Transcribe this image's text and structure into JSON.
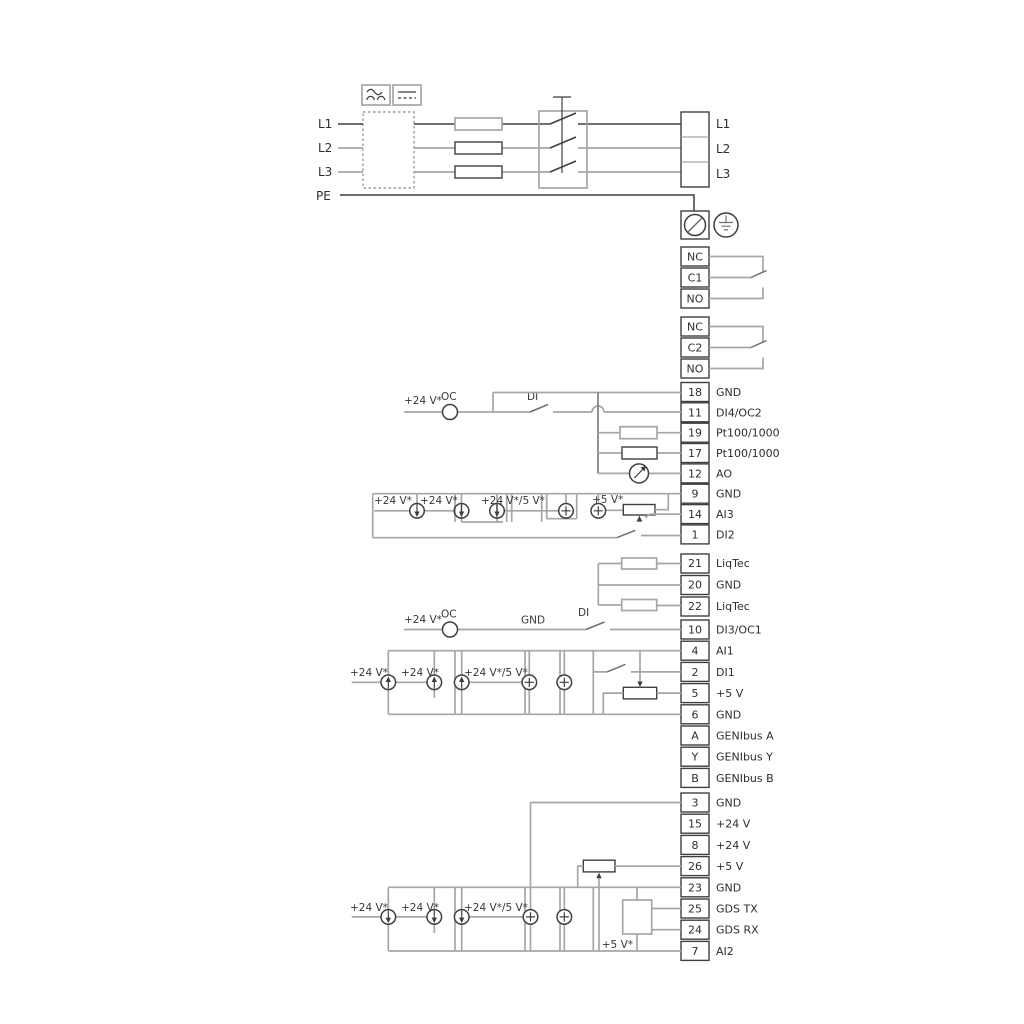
{
  "diagram_title": "pump-drive-wiring-diagram",
  "colors": {
    "wire_dark": "#3f3f3f",
    "wire_gray": "#a6a6a6",
    "text": "#2e2e2e",
    "background": "#ffffff"
  },
  "power": {
    "inputs": [
      {
        "label": "L1"
      },
      {
        "label": "L2"
      },
      {
        "label": "L3"
      }
    ],
    "pe_label": "PE",
    "outputs": [
      {
        "label": "L1"
      },
      {
        "label": "L2"
      },
      {
        "label": "L3"
      }
    ]
  },
  "relays": {
    "r1": {
      "rows": [
        {
          "n": "NC"
        },
        {
          "n": "C1"
        },
        {
          "n": "NO"
        }
      ]
    },
    "r2": {
      "rows": [
        {
          "n": "NC"
        },
        {
          "n": "C2"
        },
        {
          "n": "NO"
        }
      ]
    }
  },
  "strip1": {
    "rows": [
      {
        "n": "18",
        "l": "GND"
      },
      {
        "n": "11",
        "l": "DI4/OC2"
      },
      {
        "n": "19",
        "l": "Pt100/1000"
      },
      {
        "n": "17",
        "l": "Pt100/1000"
      },
      {
        "n": "12",
        "l": "AO"
      },
      {
        "n": "9",
        "l": "GND"
      },
      {
        "n": "14",
        "l": "AI3"
      },
      {
        "n": "1",
        "l": "DI2"
      }
    ]
  },
  "strip2": {
    "rows": [
      {
        "n": "21",
        "l": "LiqTec"
      },
      {
        "n": "20",
        "l": "GND"
      },
      {
        "n": "22",
        "l": "LiqTec"
      }
    ]
  },
  "strip3": {
    "rows": [
      {
        "n": "10",
        "l": "DI3/OC1"
      },
      {
        "n": "4",
        "l": "AI1"
      },
      {
        "n": "2",
        "l": "DI1"
      },
      {
        "n": "5",
        "l": "+5 V"
      },
      {
        "n": "6",
        "l": "GND"
      },
      {
        "n": "A",
        "l": "GENIbus A"
      },
      {
        "n": "Y",
        "l": "GENIbus Y"
      },
      {
        "n": "B",
        "l": "GENIbus B"
      }
    ]
  },
  "strip4": {
    "rows": [
      {
        "n": "3",
        "l": "GND"
      },
      {
        "n": "15",
        "l": "+24 V"
      },
      {
        "n": "8",
        "l": "+24 V"
      },
      {
        "n": "26",
        "l": "+5 V"
      },
      {
        "n": "23",
        "l": "GND"
      },
      {
        "n": "25",
        "l": "GDS TX"
      },
      {
        "n": "24",
        "l": "GDS RX"
      },
      {
        "n": "7",
        "l": "AI2"
      }
    ]
  },
  "ann": {
    "p24": "+24 V*",
    "p24_5": "+24 V*/5 V*",
    "p5": "+5 V*",
    "oc": "OC",
    "di": "DI",
    "gnd": "GND"
  }
}
